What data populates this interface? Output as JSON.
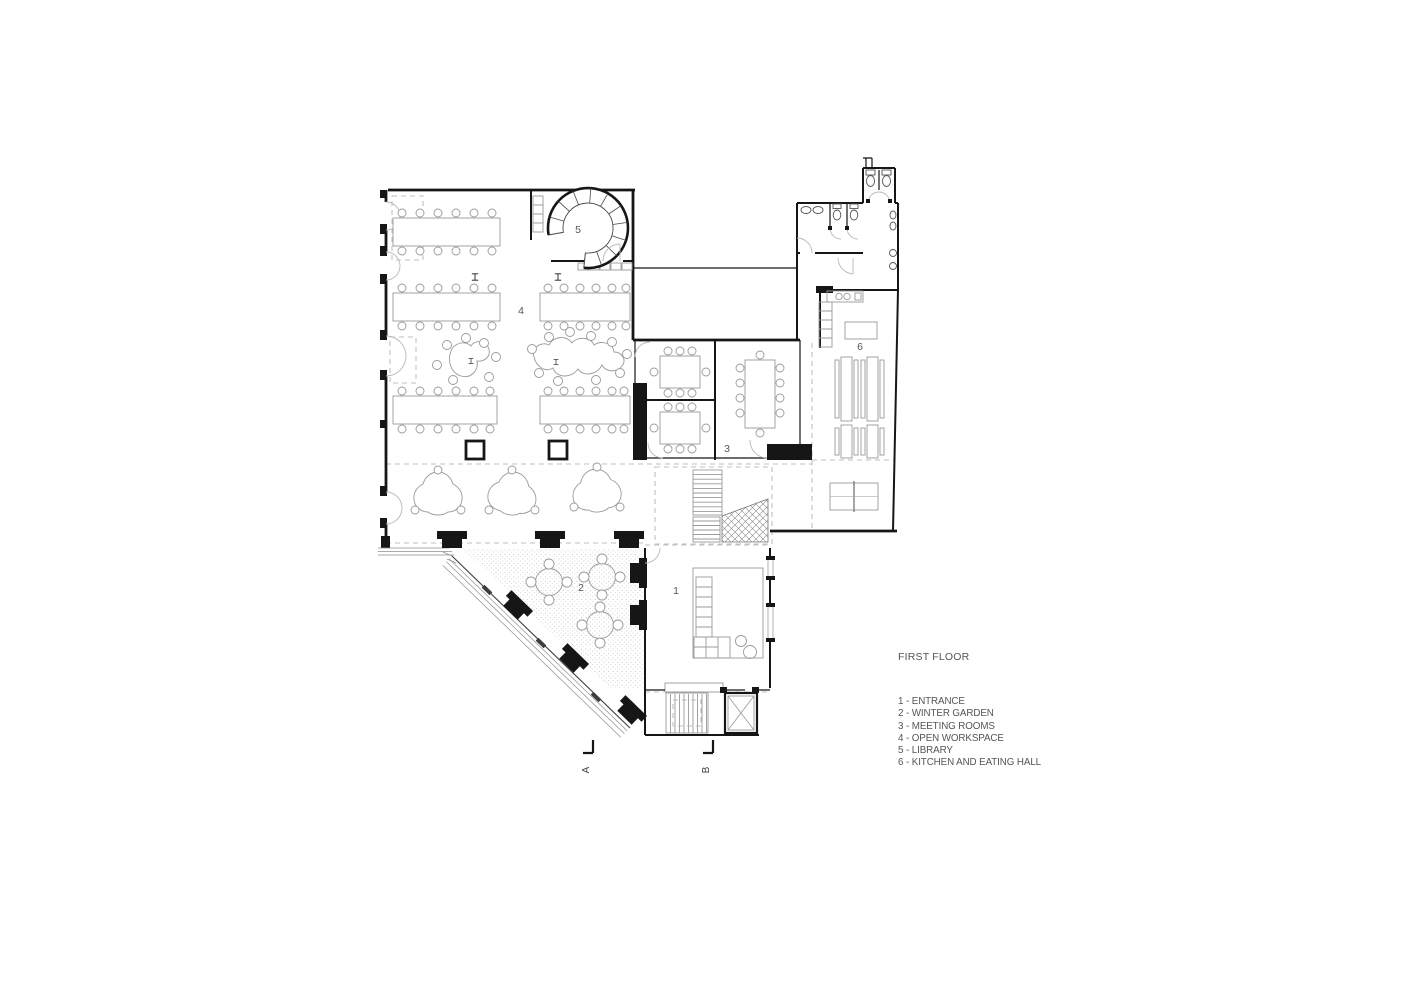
{
  "title": {
    "text": "FIRST FLOOR"
  },
  "legend": {
    "items": [
      {
        "label": "1 - ENTRANCE"
      },
      {
        "label": "2 - WINTER GARDEN"
      },
      {
        "label": "3 - MEETING ROOMS"
      },
      {
        "label": "4 - OPEN WORKSPACE"
      },
      {
        "label": "5 - LIBRARY"
      },
      {
        "label": "6 - KITCHEN AND EATING HALL"
      }
    ]
  },
  "rooms": {
    "entrance": {
      "number": "1",
      "name": "Entrance"
    },
    "winter_garden": {
      "number": "2",
      "name": "Winter garden"
    },
    "meeting_rooms": {
      "number": "3",
      "name": "Meeting rooms"
    },
    "open_workspace": {
      "number": "4",
      "name": "Open workspace"
    },
    "library": {
      "number": "5",
      "name": "Library"
    },
    "kitchen": {
      "number": "6",
      "name": "Kitchen and eating hall"
    }
  },
  "section_markers": {
    "a": "A",
    "b": "B"
  },
  "colors": {
    "background": "#ffffff",
    "wall": "#161616",
    "furniture": "#9a9a9a",
    "dashed": "#ababab",
    "text": "#555555"
  }
}
